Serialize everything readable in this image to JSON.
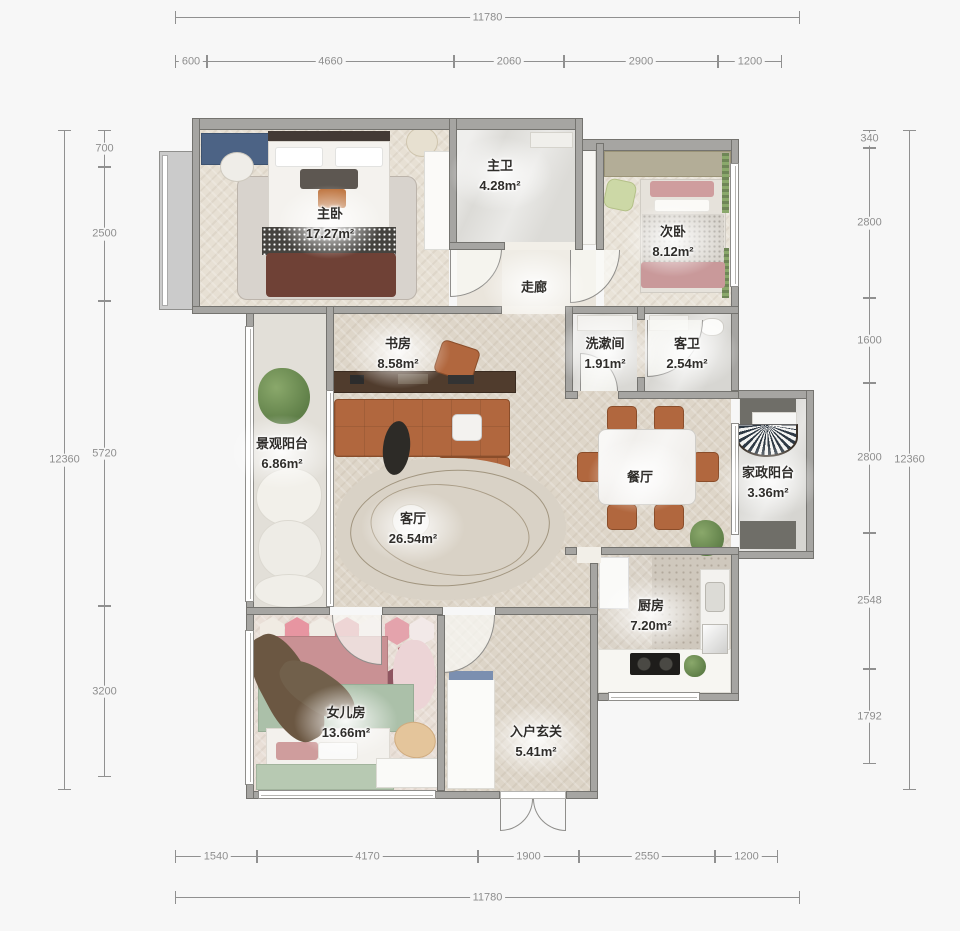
{
  "dimensions": {
    "top": {
      "total": "11780",
      "segments": [
        "600",
        "4660",
        "2060",
        "2900",
        "1200"
      ]
    },
    "bottom": {
      "total": "11780",
      "segments": [
        "1540",
        "4170",
        "1900",
        "2550",
        "1200"
      ]
    },
    "left": {
      "total": "12360",
      "segments": [
        "700",
        "2500",
        "5720",
        "3200"
      ]
    },
    "right": {
      "total": "12360",
      "segments": [
        "340",
        "2800",
        "1600",
        "2800",
        "2548",
        "1792"
      ]
    }
  },
  "rooms": {
    "master_bedroom": {
      "name": "主卧",
      "area": "17.27m²"
    },
    "master_bath": {
      "name": "主卫",
      "area": "4.28m²"
    },
    "corridor": {
      "name": "走廊",
      "area": ""
    },
    "second_bedroom": {
      "name": "次卧",
      "area": "8.12m²"
    },
    "study": {
      "name": "书房",
      "area": "8.58m²"
    },
    "washroom": {
      "name": "洗漱间",
      "area": "1.91m²"
    },
    "guest_bath": {
      "name": "客卫",
      "area": "2.54m²"
    },
    "view_balcony": {
      "name": "景观阳台",
      "area": "6.86m²"
    },
    "living_room": {
      "name": "客厅",
      "area": "26.54m²"
    },
    "dining_room": {
      "name": "餐厅",
      "area": ""
    },
    "laundry_balcony": {
      "name": "家政阳台",
      "area": "3.36m²"
    },
    "kitchen": {
      "name": "厨房",
      "area": "7.20m²"
    },
    "daughter_room": {
      "name": "女儿房",
      "area": "13.66m²"
    },
    "entry_foyer": {
      "name": "入户玄关",
      "area": "5.41m²"
    }
  },
  "colors": {
    "background": "#f7f7f7",
    "wall": "#a6a5a2",
    "dimension": "#8e8e8e",
    "wood_floor": "#ded6c9",
    "sofa_accent": "#b1673e",
    "label_text": "#2f2d2a"
  }
}
